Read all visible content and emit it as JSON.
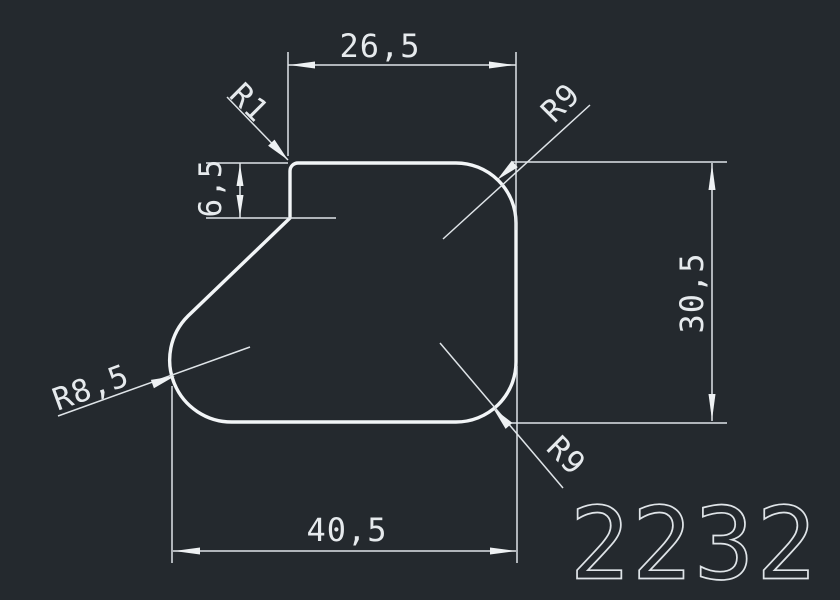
{
  "colors": {
    "background": "#24292e",
    "line": "#eef1f3"
  },
  "dimensions": {
    "top_width": "26,5",
    "step_height": "6,5",
    "overall_height": "30,5",
    "bottom_width": "40,5"
  },
  "radii": {
    "top_left": "R1",
    "top_right": "R9",
    "bottom_right": "R9",
    "bottom_left": "R8,5"
  },
  "part_number": "2232"
}
